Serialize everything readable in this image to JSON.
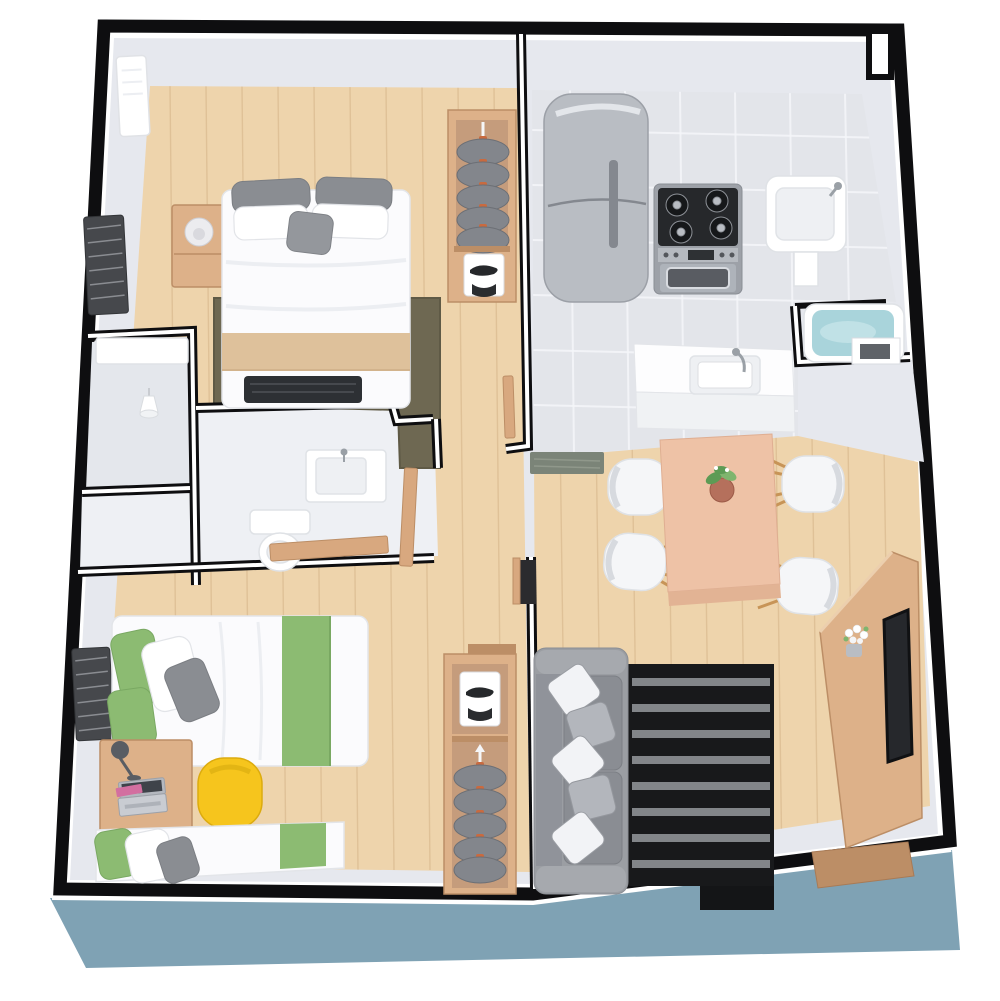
{
  "meta": {
    "title": "3D apartment floor plan",
    "description": "Isometric 3D dollhouse-style floor plan render of a two-bedroom apartment with black cut-wall outlines on a blue base platform. No text labels are rendered in the image.",
    "view": "top-down isometric render",
    "canvas": {
      "width": 1000,
      "height": 1001
    }
  },
  "palette": {
    "background": "#ffffff",
    "outline": "#0e0e10",
    "platform": "#7fa2b4",
    "wallTop": "#ffffff",
    "wallFace": "#e6e8ee",
    "woodFloor": "#eed4ac",
    "woodPlank": "#c9a277",
    "tileFloor": "#e3e5ea",
    "tileLine": "#f5f6f9",
    "bathFloor": "#eef0f4",
    "showerFloor": "#e4e7ec",
    "hallDoor": "#d8a87f",
    "furnitureWood": "#ddb189",
    "furnitureWoodDark": "#bc8e66",
    "closetInner": "#c59c7c",
    "clothesGray": "#83868c",
    "hangerOrange": "#c96a3f",
    "bedWhite": "#fbfbfd",
    "beddingShadow": "#e3e5e9",
    "beigeRunner": "#dec19b",
    "pillowGray": "#8a8d92",
    "throwBlack": "#2d3034",
    "rugOlive": "#6e6852",
    "fridgeSteel": "#b9bdc3",
    "cooktopBlack": "#26282b",
    "ovenSteel": "#aeb3ba",
    "sinkWhite": "#ffffff",
    "basinGray": "#eef0f3",
    "tubBlue": "#a9d4db",
    "matGreen": "#7b8478",
    "tableWood": "#eec2a6",
    "chairWhite": "#f5f6f8",
    "chairLegWood": "#c79457",
    "plantGreen": "#5d9b55",
    "potClay": "#b5705c",
    "sofaGray": "#9b9ea3",
    "sofaCushion": "#8a8d93",
    "sofaPillowWhite": "#f2f3f6",
    "sofaPillowGray": "#b3b6bc",
    "rugBlack": "#18191b",
    "rugStripe": "#8e9196",
    "greenAccent": "#8cbb72",
    "yellowChair": "#f6c51d",
    "laptopSilver": "#c9ccd2",
    "lampDark": "#595d63",
    "blindsDark": "#46484c",
    "doorOpening": "#2b2b2e",
    "notePink": "#d36fa0"
  },
  "apartment": {
    "base": "blue display platform with white reveal line under black cut walls",
    "rooms": [
      {
        "id": "master-bedroom",
        "label": "Master bedroom",
        "floor": "light wood",
        "furniture": [
          "double-bed",
          "gray-pillows",
          "beige-bed-runner",
          "dark-folded-throw",
          "nightstand",
          "glass-table-lamp",
          "olive-area-rug",
          "open-wardrobe-with-hanging-shirts",
          "sneaker-shirt-shelf",
          "wall-air-conditioner",
          "dark-window-blinds"
        ]
      },
      {
        "id": "shower-room",
        "label": "Shower room",
        "floor": "gray tile",
        "furniture": [
          "shower-pendant-head",
          "white-ledge"
        ]
      },
      {
        "id": "bathroom",
        "label": "Bathroom",
        "floor": "white tile",
        "furniture": [
          "vanity-sink",
          "toilet",
          "wood-sliding-door",
          "wood-door-leaf"
        ]
      },
      {
        "id": "kitchen",
        "label": "Kitchen",
        "floor": "gray tile",
        "furniture": [
          "refrigerator",
          "gas-range-with-oven",
          "utility-sink",
          "island-counter-with-sink",
          "green-doormat",
          "wood-door-leaf"
        ]
      },
      {
        "id": "tub-nook",
        "label": "Tub nook",
        "floor": "gray tile",
        "furniture": [
          "blue-bathtub",
          "white-step"
        ]
      },
      {
        "id": "living-dining",
        "label": "Living / dining room",
        "floor": "light wood",
        "furniture": [
          "dining-table",
          "potted-plant-centerpiece",
          "white-shell-chairs-x4",
          "gray-sofa",
          "white-throw-pillows",
          "black-striped-rug",
          "wood-tv-panel",
          "flat-tv",
          "white-flower-vase",
          "wood-sideboard"
        ]
      },
      {
        "id": "kids-bedroom",
        "label": "Second bedroom",
        "floor": "light wood",
        "furniture": [
          "single-bed-green",
          "second-single-bed-green",
          "study-desk",
          "open-laptop",
          "desk-lamp",
          "pink-notebook",
          "yellow-shell-chair",
          "open-closet-with-hanging-clothes",
          "sneaker-shirt-shelf",
          "dark-window-blinds"
        ]
      },
      {
        "id": "hallway",
        "label": "Hallway",
        "floor": "light wood",
        "furniture": [
          "door-openings"
        ]
      }
    ]
  }
}
